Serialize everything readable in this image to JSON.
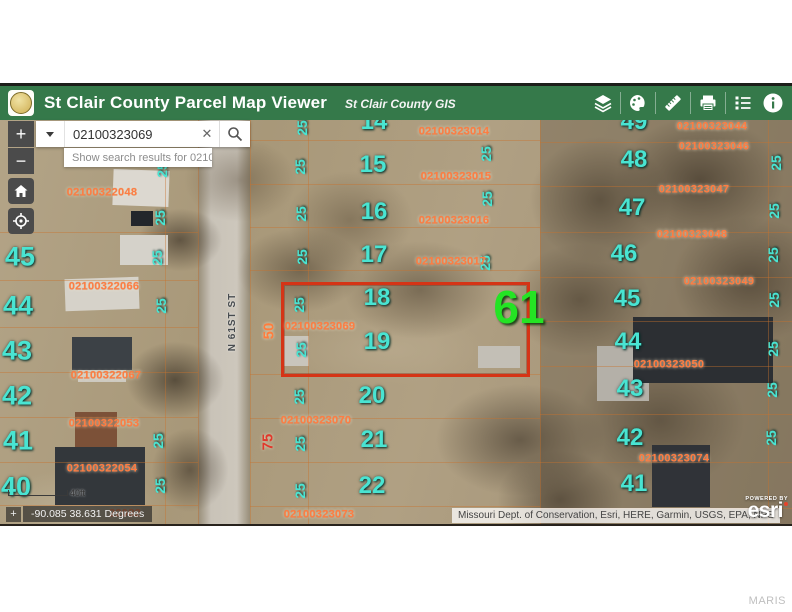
{
  "header": {
    "title": "St Clair County Parcel Map Viewer",
    "subtitle": "St Clair County GIS",
    "tools": [
      "layers",
      "draw",
      "measure",
      "print",
      "legend",
      "info"
    ]
  },
  "search": {
    "value": "02100323069",
    "suggestion": "Show search results for 02100...",
    "clear_label": "✕"
  },
  "map_controls": {
    "zoom_in": "+",
    "zoom_out": "−"
  },
  "scale": {
    "label": "40ft"
  },
  "coordinates": {
    "value": "-90.085 38.631 Degrees",
    "icon": "+"
  },
  "attribution": {
    "text": "Missouri Dept. of Conservation, Esri, HERE, Garmin, USGS, EPA, NPS",
    "powered_by": "POWERED BY",
    "brand": "esri"
  },
  "watermark": "MARIS",
  "map": {
    "highlight": {
      "t": "61",
      "x": 519,
      "y": 187
    },
    "road_label": {
      "t": "N 61ST ST",
      "x": 233,
      "y": 202,
      "r": -90
    },
    "selected_parcel_id": "02100323069",
    "accent_colors": {
      "parcel_outline": "#d53416",
      "lot_numbers": "#49e4d2",
      "parcel_ids": "#ff7d42",
      "highlight": "#24e424"
    },
    "lots": [
      {
        "t": "7",
        "x": 22,
        "y": 41,
        "s": 22
      },
      {
        "t": "45",
        "x": 20,
        "y": 137,
        "s": 27
      },
      {
        "t": "44",
        "x": 18,
        "y": 186,
        "s": 27
      },
      {
        "t": "43",
        "x": 17,
        "y": 231,
        "s": 27
      },
      {
        "t": "42",
        "x": 17,
        "y": 276,
        "s": 27
      },
      {
        "t": "41",
        "x": 18,
        "y": 321,
        "s": 27
      },
      {
        "t": "40",
        "x": 16,
        "y": 367,
        "s": 27
      },
      {
        "t": "14",
        "x": 374,
        "y": 2,
        "s": 24
      },
      {
        "t": "15",
        "x": 373,
        "y": 45,
        "s": 24
      },
      {
        "t": "16",
        "x": 374,
        "y": 92,
        "s": 24
      },
      {
        "t": "17",
        "x": 374,
        "y": 135,
        "s": 24
      },
      {
        "t": "18",
        "x": 377,
        "y": 178,
        "s": 24
      },
      {
        "t": "19",
        "x": 377,
        "y": 222,
        "s": 24
      },
      {
        "t": "20",
        "x": 372,
        "y": 276,
        "s": 24
      },
      {
        "t": "21",
        "x": 374,
        "y": 320,
        "s": 24
      },
      {
        "t": "22",
        "x": 372,
        "y": 366,
        "s": 24
      },
      {
        "t": "49",
        "x": 634,
        "y": 2,
        "s": 24
      },
      {
        "t": "48",
        "x": 634,
        "y": 40,
        "s": 24
      },
      {
        "t": "47",
        "x": 632,
        "y": 88,
        "s": 24
      },
      {
        "t": "46",
        "x": 624,
        "y": 134,
        "s": 24
      },
      {
        "t": "45",
        "x": 627,
        "y": 179,
        "s": 24
      },
      {
        "t": "44",
        "x": 628,
        "y": 222,
        "s": 24
      },
      {
        "t": "43",
        "x": 630,
        "y": 269,
        "s": 24
      },
      {
        "t": "42",
        "x": 630,
        "y": 318,
        "s": 24
      },
      {
        "t": "41",
        "x": 634,
        "y": 364,
        "s": 24
      }
    ],
    "dims": [
      {
        "t": "25",
        "x": 162,
        "y": 50,
        "r": -90
      },
      {
        "t": "25",
        "x": 160,
        "y": 98,
        "r": -90
      },
      {
        "t": "25",
        "x": 157,
        "y": 138,
        "r": -90
      },
      {
        "t": "25",
        "x": 161,
        "y": 186,
        "r": -90
      },
      {
        "t": "25",
        "x": 158,
        "y": 321,
        "r": -90
      },
      {
        "t": "25",
        "x": 160,
        "y": 366,
        "r": -90
      },
      {
        "t": "25",
        "x": 302,
        "y": 8,
        "r": -90
      },
      {
        "t": "25",
        "x": 300,
        "y": 47,
        "r": -90
      },
      {
        "t": "25",
        "x": 301,
        "y": 94,
        "r": -90
      },
      {
        "t": "25",
        "x": 302,
        "y": 137,
        "r": -90
      },
      {
        "t": "25",
        "x": 299,
        "y": 185,
        "r": -90
      },
      {
        "t": "25",
        "x": 301,
        "y": 230,
        "r": -90
      },
      {
        "t": "25",
        "x": 299,
        "y": 277,
        "r": -90
      },
      {
        "t": "25",
        "x": 300,
        "y": 324,
        "r": -90
      },
      {
        "t": "25",
        "x": 300,
        "y": 371,
        "r": -90
      },
      {
        "t": "25",
        "x": 486,
        "y": 34,
        "r": -90
      },
      {
        "t": "25",
        "x": 487,
        "y": 79,
        "r": -90
      },
      {
        "t": "25",
        "x": 485,
        "y": 143,
        "r": -90
      },
      {
        "t": "25",
        "x": 776,
        "y": 43,
        "r": -90
      },
      {
        "t": "25",
        "x": 774,
        "y": 91,
        "r": -90
      },
      {
        "t": "25",
        "x": 773,
        "y": 135,
        "r": -90
      },
      {
        "t": "25",
        "x": 774,
        "y": 180,
        "r": -90
      },
      {
        "t": "25",
        "x": 773,
        "y": 229,
        "r": -90
      },
      {
        "t": "25",
        "x": 772,
        "y": 270,
        "r": -90
      },
      {
        "t": "25",
        "x": 771,
        "y": 318,
        "r": -90
      },
      {
        "t": "50",
        "x": 269,
        "y": 211,
        "r": -90,
        "s": 15,
        "c": "o"
      },
      {
        "t": "75",
        "x": 268,
        "y": 322,
        "r": -90,
        "s": 15,
        "c": "r"
      }
    ],
    "parcel_ids": [
      {
        "t": "02100322048",
        "x": 102,
        "y": 73
      },
      {
        "t": "02100322066",
        "x": 104,
        "y": 167
      },
      {
        "t": "02100322067",
        "x": 106,
        "y": 256
      },
      {
        "t": "02100322053",
        "x": 104,
        "y": 304
      },
      {
        "t": "02100322054",
        "x": 102,
        "y": 349
      },
      {
        "t": "22082",
        "x": 125,
        "y": 394
      },
      {
        "t": "02100323014",
        "x": 454,
        "y": 12
      },
      {
        "t": "02100323015",
        "x": 456,
        "y": 57
      },
      {
        "t": "02100323016",
        "x": 454,
        "y": 101
      },
      {
        "t": "02100323017",
        "x": 451,
        "y": 142
      },
      {
        "t": "02100323044",
        "x": 712,
        "y": 7
      },
      {
        "t": "02100323046",
        "x": 714,
        "y": 27
      },
      {
        "t": "02100323047",
        "x": 694,
        "y": 70
      },
      {
        "t": "02100323048",
        "x": 692,
        "y": 115
      },
      {
        "t": "02100323049",
        "x": 719,
        "y": 162
      },
      {
        "t": "02100323050",
        "x": 669,
        "y": 245
      },
      {
        "t": "02100323069",
        "x": 320,
        "y": 207
      },
      {
        "t": "02100323070",
        "x": 316,
        "y": 301
      },
      {
        "t": "02100323073",
        "x": 319,
        "y": 395
      },
      {
        "t": "02100323074",
        "x": 674,
        "y": 339
      }
    ]
  }
}
